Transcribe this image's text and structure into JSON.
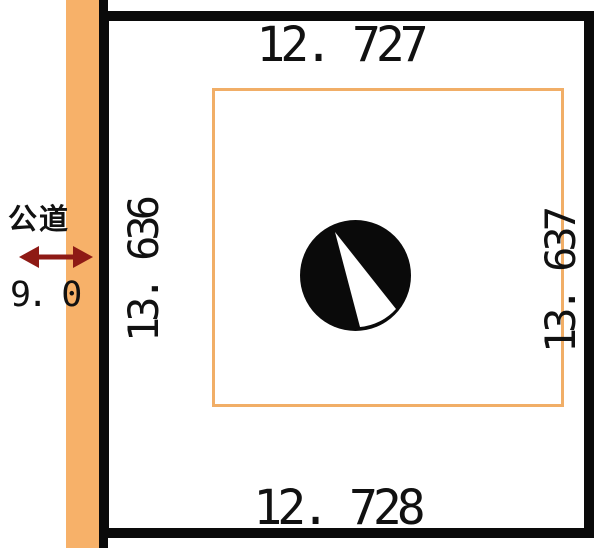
{
  "page": {
    "background_color": "#ffffff"
  },
  "road": {
    "label": "公道",
    "width_value": "9. 0",
    "fill_color": "#f7b169",
    "arrow_color": "#8e1a15"
  },
  "lot": {
    "dim_top": "12. 727",
    "dim_bottom": "12. 728",
    "dim_left": "13. 636",
    "dim_right": "13. 637",
    "border_color": "#0a0a0a",
    "inner_line_color": "#f1ae67"
  },
  "icons": {
    "road_width_arrow": "double-headed-horizontal-arrow",
    "north_symbol": "black-circle-with-white-wedge"
  }
}
